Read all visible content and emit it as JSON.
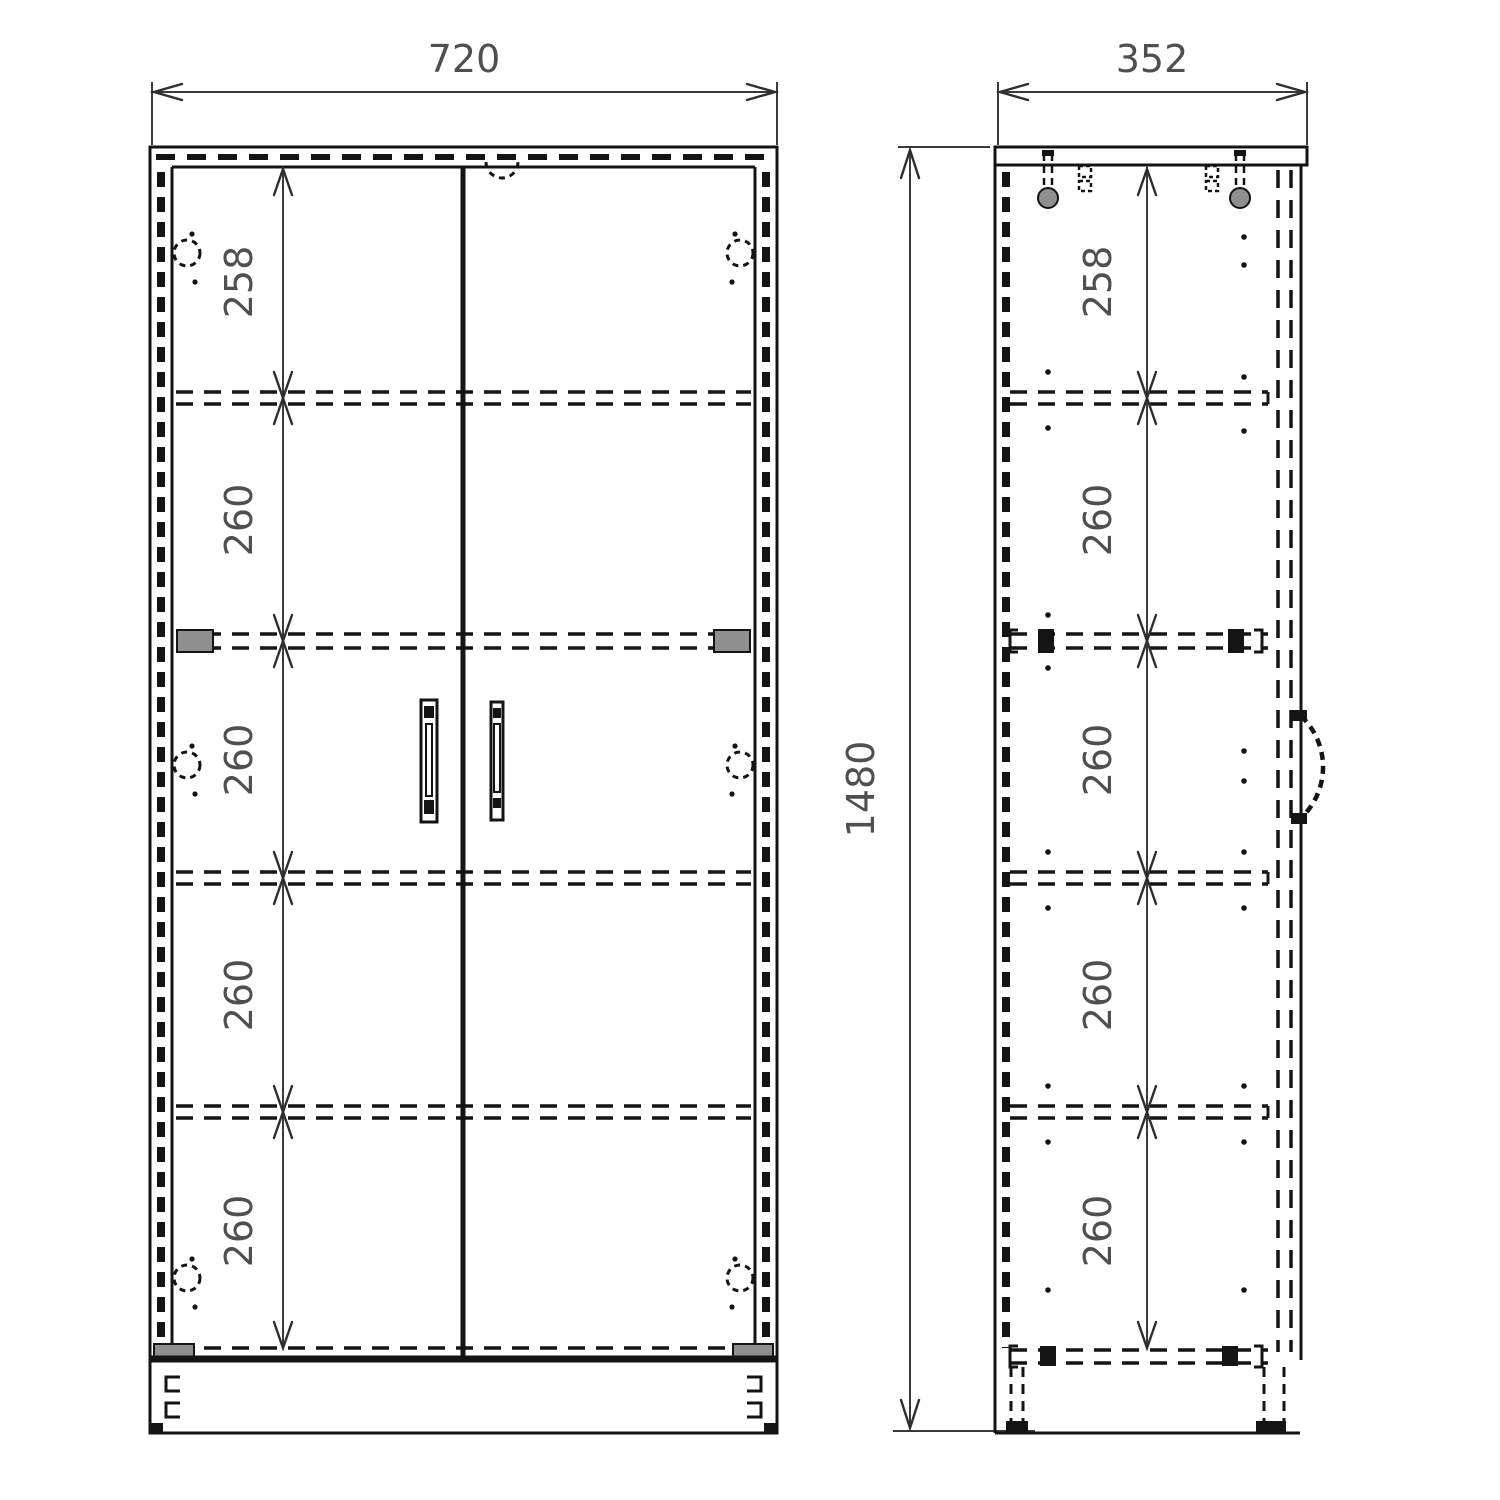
{
  "drawing": {
    "type": "furniture-technical-drawing",
    "front_view": {
      "width_label": "720",
      "section_labels": [
        "258",
        "260",
        "260",
        "260",
        "260"
      ]
    },
    "side_view": {
      "depth_label": "352",
      "section_labels": [
        "258",
        "260",
        "260",
        "260",
        "260"
      ]
    },
    "height_label": "1480"
  },
  "colors": {
    "line": "#141414",
    "dimension_text": "#4f4f4f",
    "hardware_gray": "#8f8f8f",
    "background": "#ffffff"
  }
}
